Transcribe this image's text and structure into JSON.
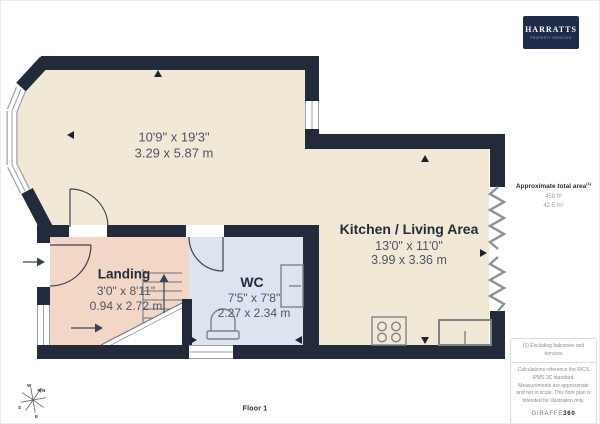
{
  "meta": {
    "floor_label": "Floor 1"
  },
  "branding": {
    "logo_title": "HARRATTS",
    "logo_subtitle": "PROPERTY SERVICES"
  },
  "area_summary": {
    "label": "Approximate total area",
    "superscript": "(1)",
    "imperial": "458 ft²",
    "metric": "42.5 m²"
  },
  "rooms": {
    "living": {
      "dims_imperial": "10'9\" x 19'3\"",
      "dims_metric": "3.29 x 5.87 m"
    },
    "kitchen_living": {
      "name": "Kitchen / Living Area",
      "dims_imperial": "13'0\" x 11'0\"",
      "dims_metric": "3.99 x 3.36 m"
    },
    "landing": {
      "name": "Landing",
      "dims_imperial": "3'0\" x 8'11\"",
      "dims_metric": "0.94 x 2.72 m"
    },
    "wc": {
      "name": "WC",
      "dims_imperial": "7'5\" x 7'8\"",
      "dims_metric": "2.27 x 2.34 m"
    }
  },
  "footnote": "(1) Excluding balconies and terraces",
  "disclaimer": "Calculations reference the RICS IPMS 3C standard. Measurements are approximate and not to scale. This floor plan is intended for illustration only.",
  "provider": {
    "name": "GIRAFFE",
    "suffix": "360"
  },
  "compass": {
    "n": "N",
    "e": "E",
    "s": "S",
    "w": "W"
  },
  "colors": {
    "wall": "#232b3a",
    "floor_main": "#f1e9d6",
    "floor_landing": "#f2d6c6",
    "floor_wc": "#dee3f0",
    "logo_bg": "#1e2b4b",
    "fixture_stroke": "#7d838d",
    "window_frame": "#9aa0a8"
  }
}
